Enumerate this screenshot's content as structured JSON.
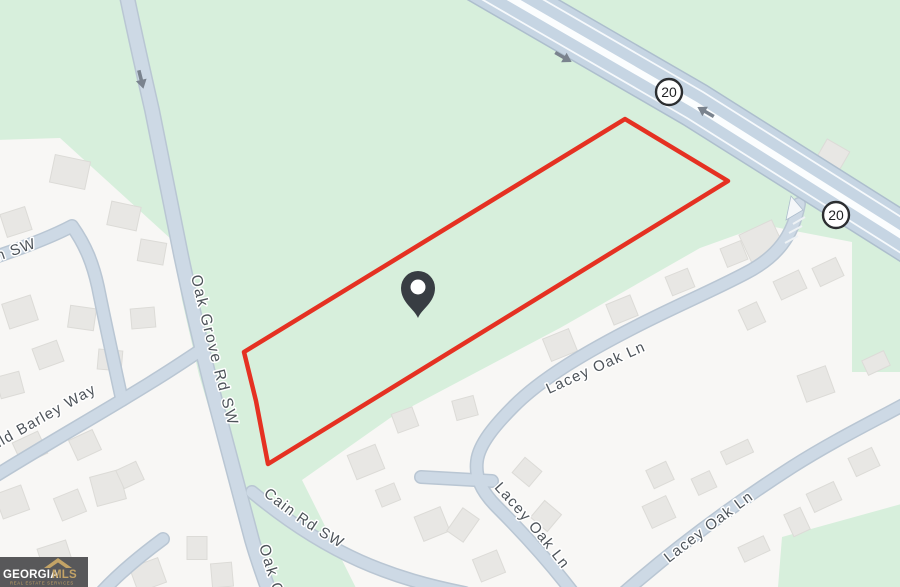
{
  "map": {
    "description": "Real estate listing map with red parcel outline near highway 20",
    "colors": {
      "bg_green": "#d7efdc",
      "residential": "#f8f7f5",
      "house": "#e8e7e4",
      "house_border": "#dcdbd7",
      "road_fill": "#cdd9e5",
      "road_casing": "#b9c6d3",
      "highway_fill": "#c6d5e3",
      "highway_casing": "#adbecd",
      "road_white_line": "#fbfdfe",
      "label_text": "#4d5359",
      "label_halo": "#ffffff",
      "parcel_red": "#e53122",
      "pin_dark": "#383d43",
      "shield_border": "#2b2d30",
      "arrow_gray": "#7a838e",
      "logo_bg": "#58585a",
      "logo_gold": "#c3a366",
      "logo_white": "#ffffff"
    },
    "labels": {
      "oak_grove": "Oak Grove Rd SW",
      "oak_grove_partial": "Oak Grove Rd SW",
      "wild_barley": "Wild Barley Way",
      "cain": "Cain Rd SW",
      "lacey_1": "Lacey Oak Ln",
      "lacey_2": "Lacey Oak Ln",
      "lacey_3": "Lacey Oak Ln",
      "left_partial": "n SW"
    },
    "highway": {
      "shield_1": "20",
      "shield_2": "20"
    },
    "parcel": {
      "points": "625,119 728,181 268,464 256,401 244,352"
    },
    "pin": {
      "transform": "translate(418,318)"
    },
    "houses": [
      [
        70,
        172,
        36,
        28,
        12
      ],
      [
        124,
        216,
        30,
        24,
        12
      ],
      [
        16,
        222,
        26,
        24,
        -18
      ],
      [
        152,
        252,
        26,
        22,
        10
      ],
      [
        20,
        312,
        30,
        26,
        -18
      ],
      [
        82,
        318,
        26,
        22,
        8
      ],
      [
        143,
        318,
        24,
        20,
        -5
      ],
      [
        48,
        355,
        26,
        22,
        -20
      ],
      [
        110,
        360,
        24,
        20,
        5
      ],
      [
        10,
        385,
        24,
        22,
        -15
      ],
      [
        30,
        448,
        28,
        24,
        -25
      ],
      [
        85,
        445,
        26,
        22,
        -25
      ],
      [
        12,
        502,
        28,
        26,
        -20
      ],
      [
        70,
        505,
        26,
        24,
        -22
      ],
      [
        108,
        488,
        30,
        30,
        -15
      ],
      [
        55,
        556,
        30,
        24,
        -18
      ],
      [
        148,
        575,
        30,
        26,
        -20
      ],
      [
        197,
        548,
        20,
        23,
        0
      ],
      [
        222,
        575,
        21,
        24,
        -5
      ],
      [
        130,
        475,
        22,
        20,
        -25
      ],
      [
        560,
        345,
        28,
        24,
        -22
      ],
      [
        622,
        310,
        26,
        22,
        -22
      ],
      [
        680,
        282,
        24,
        20,
        -22
      ],
      [
        734,
        254,
        22,
        20,
        -22
      ],
      [
        405,
        420,
        22,
        20,
        -20
      ],
      [
        465,
        408,
        22,
        20,
        -15
      ],
      [
        366,
        462,
        30,
        26,
        -22
      ],
      [
        432,
        524,
        28,
        26,
        -22
      ],
      [
        489,
        566,
        26,
        24,
        -22
      ],
      [
        388,
        495,
        20,
        18,
        -22
      ],
      [
        527,
        472,
        22,
        20,
        40
      ],
      [
        463,
        525,
        20,
        28,
        35
      ],
      [
        546,
        516,
        22,
        22,
        40
      ],
      [
        660,
        475,
        22,
        20,
        -25
      ],
      [
        704,
        483,
        20,
        18,
        -25
      ],
      [
        737,
        452,
        30,
        14,
        -25
      ],
      [
        816,
        384,
        30,
        28,
        -20
      ],
      [
        876,
        363,
        24,
        16,
        -25
      ],
      [
        864,
        462,
        26,
        20,
        -25
      ],
      [
        824,
        497,
        30,
        20,
        -25
      ],
      [
        797,
        522,
        18,
        24,
        -25
      ],
      [
        659,
        512,
        26,
        24,
        -25
      ],
      [
        754,
        549,
        28,
        16,
        -25
      ],
      [
        762,
        242,
        36,
        32,
        -25
      ],
      [
        828,
        272,
        26,
        20,
        -25
      ],
      [
        790,
        285,
        28,
        20,
        -25
      ],
      [
        752,
        316,
        20,
        22,
        -25
      ],
      [
        833,
        155,
        26,
        22,
        30
      ]
    ],
    "logo": {
      "brand_primary": "GEORGIA",
      "brand_secondary": "MLS",
      "tagline": "REAL ESTATE SERVICES"
    }
  }
}
